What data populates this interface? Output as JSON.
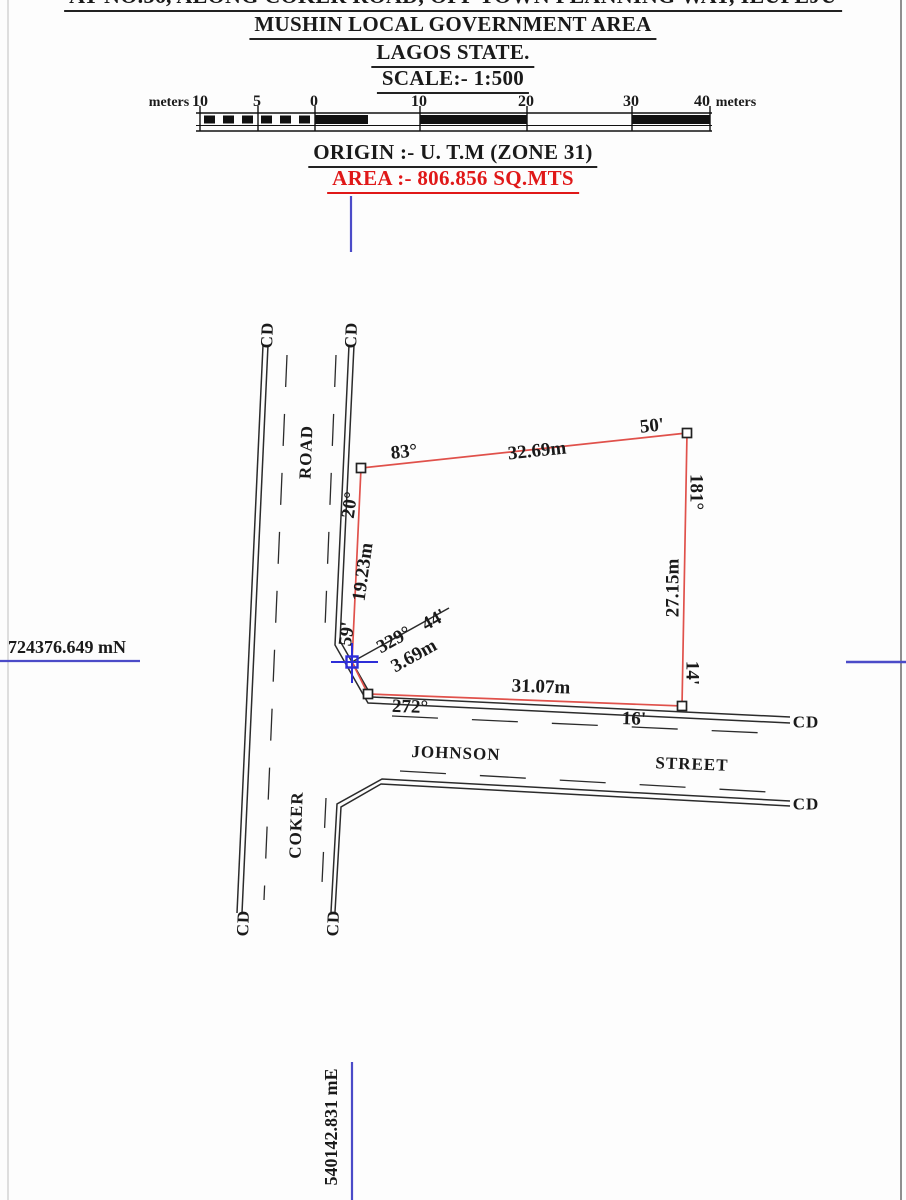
{
  "header": {
    "line1": "AT NO.36, ALONG COKER ROAD, OFF TOWN PLANNING WAY, ILUPEJU",
    "line2": "MUSHIN LOCAL GOVERNMENT AREA",
    "line3": "LAGOS STATE.",
    "scale": "SCALE:- 1:500",
    "origin": "ORIGIN :- U. T.M (ZONE 31)",
    "area": "AREA :-  806.856 SQ.MTS"
  },
  "scale_bar": {
    "unit_left": "meters",
    "unit_right": "meters",
    "ticks": [
      "10",
      "5",
      "0",
      "10",
      "20",
      "30",
      "40"
    ]
  },
  "grid": {
    "northing": "724376.649 mN",
    "easting": "540142.831 mE"
  },
  "parcel": {
    "edges": [
      {
        "side": "north",
        "deg": "83°",
        "min": "50'",
        "dist": "32.69m"
      },
      {
        "side": "east",
        "deg": "181°",
        "min": "14'",
        "dist": "27.15m"
      },
      {
        "side": "south",
        "deg": "272°",
        "min": "16'",
        "dist": "31.07m"
      },
      {
        "side": "tie",
        "deg": "329°",
        "min": "44'",
        "dist": "3.69m"
      },
      {
        "side": "west",
        "deg": "20°",
        "min": "59'",
        "dist": "19.23m"
      }
    ]
  },
  "roads": {
    "coker_word": "COKER",
    "road_word": "ROAD",
    "johnson_word": "JOHNSON",
    "street_word": "STREET",
    "cd": "CD"
  },
  "colors": {
    "parcel_red": "#e0514b",
    "grid_blue": "#4b4bc8",
    "area_red": "#e01818",
    "ink": "#1a1a1a"
  }
}
